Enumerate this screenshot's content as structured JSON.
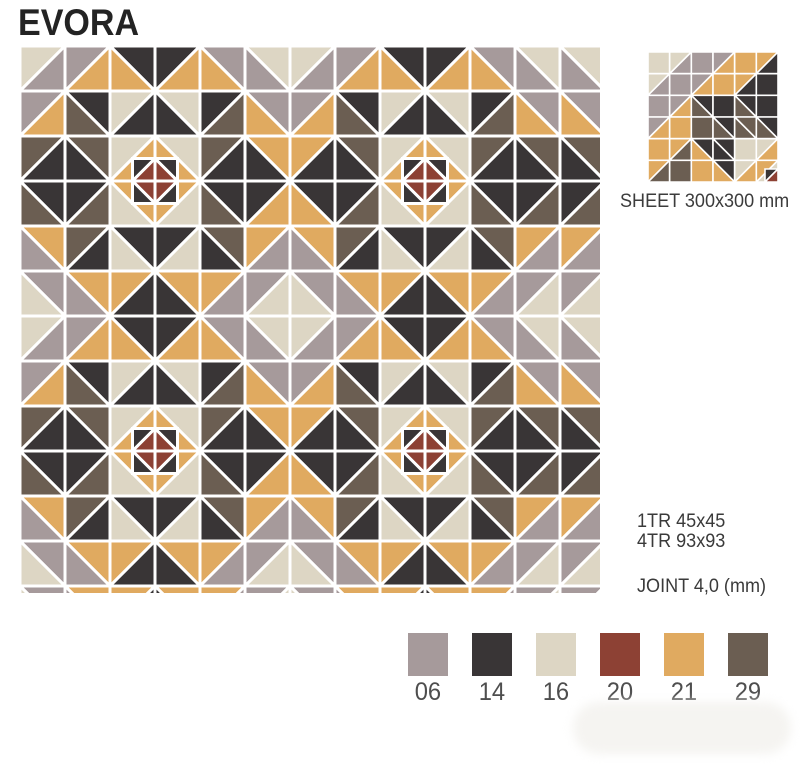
{
  "title": "EVORA",
  "colors": {
    "06": "#a69a9b",
    "14": "#393536",
    "16": "#ddd6c4",
    "20": "#8d4134",
    "21": "#e0aa60",
    "29": "#6b5e52",
    "joint": "#ffffff"
  },
  "pattern": {
    "cell": 45,
    "width": 580,
    "height": 547,
    "joint_width": 3,
    "quadrant": [
      [
        "/:16:06",
        "/:06:21",
        "\\:14:21",
        "/:14:21",
        "\\:06:21",
        "\\:16:06"
      ],
      [
        "/:06:21",
        "\\:14:29",
        "/:16:14",
        "\\:16:14",
        "/:14:29",
        "\\:06:21"
      ],
      [
        "/:29:14",
        "\\:29:14",
        "/:16:21",
        "\\:16:21",
        "/:29:14",
        "\\:21:14"
      ],
      [
        "\\:14:29",
        "/:14:29",
        "\\:21:16",
        "/:21:16",
        "\\:14:29",
        "/:14:21"
      ],
      [
        "\\:21:06",
        "/:29:14",
        "\\:14:16",
        "/:14:16",
        "\\:29:14",
        "/:21:06"
      ],
      [
        "\\:06:16",
        "\\:21:06",
        "/:21:14",
        "\\:21:14",
        "/:21:06",
        "/:06:16"
      ]
    ],
    "x_block": [
      "/:14:20",
      "\\:14:20",
      "\\:20:14",
      "/:20:14"
    ],
    "x_centers": [
      [
        135,
        135
      ],
      [
        405,
        135
      ],
      [
        135,
        405
      ],
      [
        405,
        405
      ]
    ],
    "x_sub": 22.5
  },
  "sheet_preview": {
    "size": 130,
    "joint_width": 1.6,
    "cells": [
      [
        "s:16",
        "/:16:06",
        "s:06",
        "/:06:21",
        "s:21",
        "/:21:14"
      ],
      [
        "/:16:06",
        "s:06",
        "/:06:21",
        "s:21",
        "/:21:14",
        "s:14"
      ],
      [
        "s:06",
        "/:06:21",
        "\\:14:29",
        "s:14",
        "\\:14:29",
        "s:14"
      ],
      [
        "/:06:21",
        "s:21",
        "s:29",
        "\\:14:29",
        "\\:29:29",
        "\\:14:29"
      ],
      [
        "s:21",
        "/:21:29",
        "\\:14:21",
        "\\:14:14",
        "s:16",
        "/:16:21"
      ],
      [
        "/:21:29",
        "s:29",
        "s:21",
        "\\:14:21",
        "/:16:21",
        "/:21:16"
      ]
    ],
    "corner_mini": {
      "spec": "/:14:20",
      "size": 13
    },
    "label": "SHEET 300x300 mm"
  },
  "specs": {
    "line1": "1TR 45x45",
    "line2": "4TR 93x93",
    "joint": "JOINT 4,0 (mm)"
  },
  "palette": [
    {
      "code": "06"
    },
    {
      "code": "14"
    },
    {
      "code": "16"
    },
    {
      "code": "20"
    },
    {
      "code": "21"
    },
    {
      "code": "29"
    }
  ]
}
